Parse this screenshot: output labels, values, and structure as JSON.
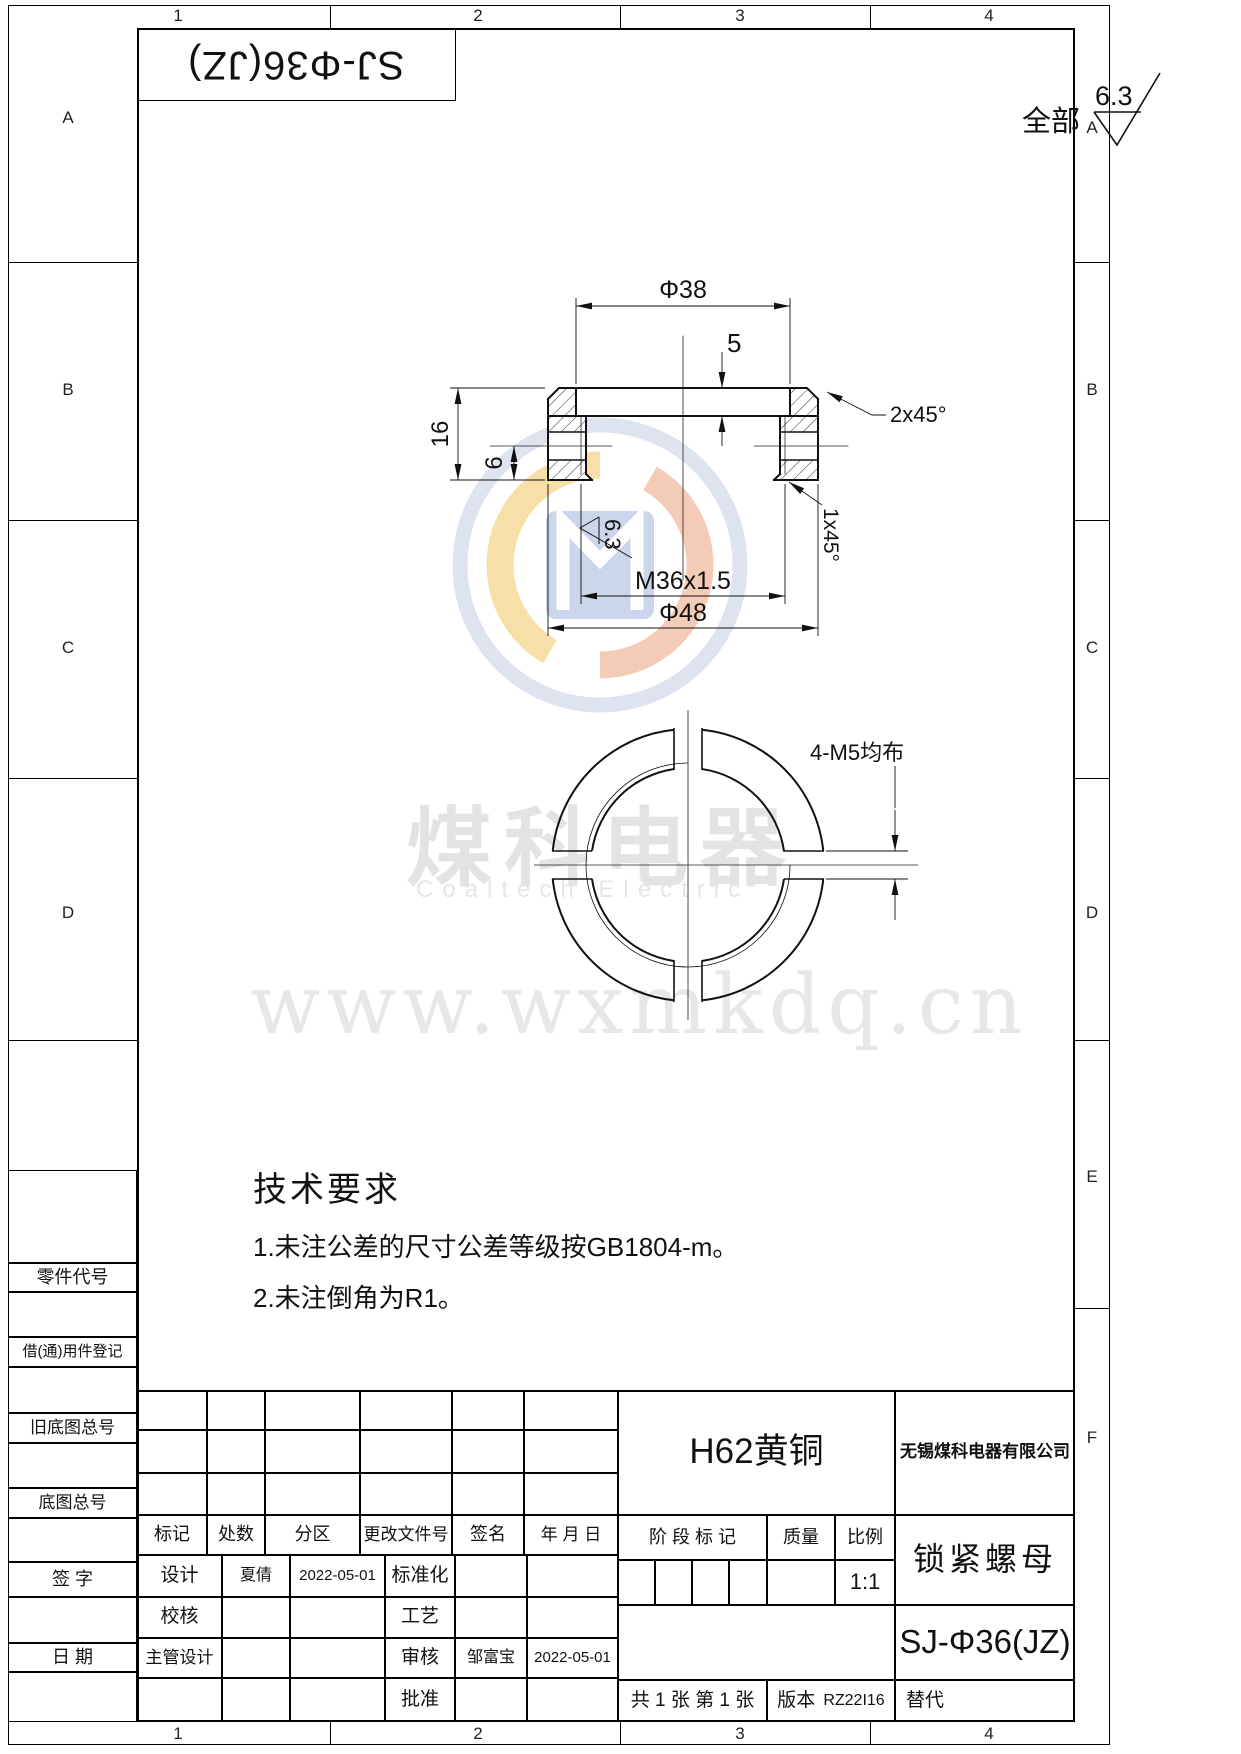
{
  "zones": {
    "top": [
      "1",
      "2",
      "3",
      "4"
    ],
    "bottom": [
      "1",
      "2",
      "3",
      "4"
    ],
    "left": [
      "A",
      "B",
      "C",
      "D"
    ],
    "right": [
      "A",
      "B",
      "C",
      "D",
      "E",
      "F"
    ]
  },
  "corner_title": "SJ-Φ36(JZ)",
  "surface_note": {
    "label": "全部",
    "value": "6.3"
  },
  "views": {
    "section": {
      "d38": "Φ38",
      "t5": "5",
      "t16": "16",
      "t6": "6",
      "thread": "M36x1.5",
      "d48": "Φ48",
      "ch2": "2x45°",
      "ch1": "1x45°",
      "rough": "6.3"
    },
    "front": {
      "label": "4-M5均布"
    }
  },
  "tech": {
    "title": "技术要求",
    "items": [
      "1.未注公差的尺寸公差等级按GB1804-m。",
      "2.未注倒角为R1。"
    ]
  },
  "watermark": {
    "cn": "煤科电器",
    "en": "Coaltech Electric",
    "url": "www.wxmkdq.cn"
  },
  "side": [
    "零件代号",
    "借(通)用件登记",
    "旧底图总号",
    "底图总号",
    "签 字",
    "日 期"
  ],
  "tb": {
    "rev_headers": [
      "标记",
      "处数",
      "分区",
      "更改文件号",
      "签名",
      "年 月 日"
    ],
    "sign_rows": [
      {
        "role": "设计",
        "name": "夏倩",
        "date": "2022-05-01",
        "role2": "标准化",
        "name2": "",
        "date2": ""
      },
      {
        "role": "校核",
        "name": "",
        "date": "",
        "role2": "工艺",
        "name2": "",
        "date2": ""
      },
      {
        "role": "主管设计",
        "name": "",
        "date": "",
        "role2": "审核",
        "name2": "邹富宝",
        "date2": "2022-05-01"
      },
      {
        "role": "",
        "name": "",
        "date": "",
        "role2": "批准",
        "name2": "",
        "date2": ""
      }
    ],
    "material": "H62黄铜",
    "company": "无锡煤科电器有限公司",
    "stage_label": "阶 段 标 记",
    "weight_label": "质量",
    "scale_label": "比例",
    "scale_value": "1:1",
    "part_name": "锁紧螺母",
    "drawing_no": "SJ-Φ36(JZ)",
    "sheet_info": "共 1 张  第 1 张",
    "version_label": "版本",
    "version_value": "RZ22I16",
    "replace_label": "替代"
  }
}
